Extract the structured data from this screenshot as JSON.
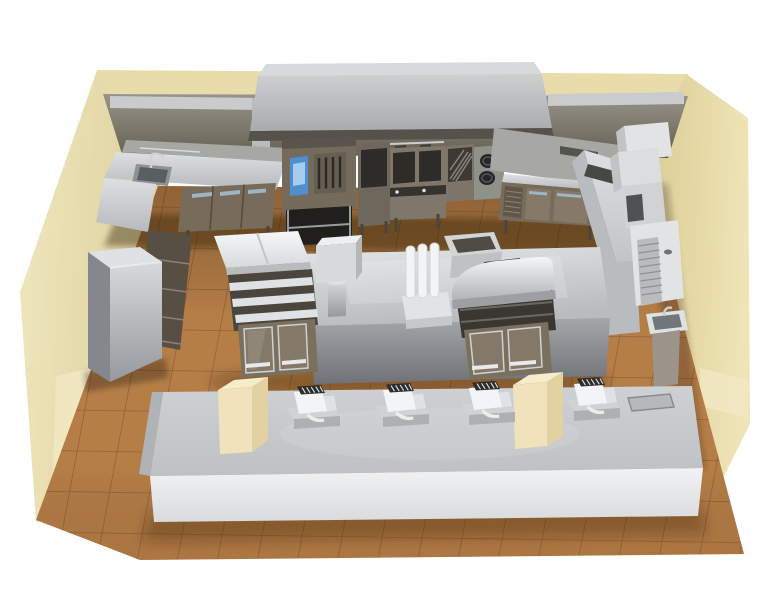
{
  "scene": {
    "type": "3d-render",
    "subject": "Commercial fast-food kitchen layout, isometric overhead view",
    "background": "#ffffff"
  },
  "colors": {
    "wallMid": "#e8dcaa",
    "wallLight": "#f1e8c2",
    "railSteel": "#c9cbcd",
    "hoodTop": "#d7d9db",
    "hoodTrim": "#55524c",
    "floorBase": "#b57e47",
    "splashGray": "#a7a7a3",
    "steelLight": "#dfe2e4",
    "steelMid": "#b9bcbe",
    "steelDark": "#8f9295",
    "brownBody": "#776b59",
    "brownDoor": "#857968",
    "brownDark": "#5f574a",
    "drawerBody": "#584f44",
    "fridgeSide": "#84888c",
    "ovenBody": "#756b5c",
    "ovenTop": "#5a544c",
    "ovenDoor": "#665e50",
    "cavityDark": "#211f1c",
    "panelDark": "#2e2c28",
    "screenBlue": "#4f8fd0",
    "screenBlueLight": "#a8ccf0",
    "holdBody": "#6e675c",
    "fryerBody": "#7f776a",
    "basketDark": "#3f3d38",
    "controlDark": "#35332e",
    "broilBody": "#7c7568",
    "louverDark": "#3d3a34",
    "burnerBody": "#8f9288",
    "burnerDark": "#26262a",
    "slotDark": "#55534d",
    "dropinDark": "#464844",
    "offWhite": "#e2e3e5",
    "cabSide": "#c2c3c5",
    "microDark": "#4e5254",
    "sinkInner": "#595e60",
    "basinDark": "#70767a",
    "pedestalTan": "#9a948a",
    "glassBrown": "#7b6f5d",
    "handleSilver": "#e8e9eb",
    "handleBlue": "#9fb4c4",
    "shelfDark": "#4a463e",
    "binCavity": "#4f4c46",
    "trayDark": "#3c3a36",
    "white": "#f3f4f5",
    "plinth": "#d0d2d4",
    "plinthFront": "#aeb0b2",
    "ventDark": "#2d2d2d",
    "creamFront": "#f0e3bb",
    "creamSide": "#e2d2a2",
    "creamTop": "#f6ecca",
    "capGray": "#b0b3b5",
    "traySlot": "#b6b9bb"
  },
  "objects": {
    "walls": "cream room walls",
    "floor": "tan ceramic tile floor",
    "exhaust_hood": "exhaust hood",
    "sink_counter": "corner sink counter with faucet",
    "under_sink_cabinets": "base cabinets with handles",
    "combi_oven": "combi oven with blue display on open stand",
    "holding_cabinet": "holding cabinet",
    "fryer_station": "double deep fryer with baskets",
    "charbroiler": "charbroiler",
    "double_burner": "twin round burner unit",
    "worktop_fridge": "refrigerated worktop with vent panel and two doors",
    "return_counter": "right-wall return counter",
    "wall_cabinets": "white wall cabinets",
    "microwave_unit": "countertop oven unit",
    "ice_machine": "ice machine with corrugated grille",
    "hand_sink": "pedestal hand-wash sink",
    "upright_fridge": "tall upright refrigerator",
    "drawer_unit": "drawer column",
    "prep_table": "tiered prep table",
    "glass_cabinets": "glass-door base cabinets",
    "island_counter": "stainless center island",
    "pedestal_unit": "pedestal-mounted unit",
    "pump_dispensers": "three pump dispensers",
    "heat_lamp_station": "curved heated holding station",
    "ingredient_bin": "open ingredient bin",
    "service_counter": "front service counter",
    "cream_pillars": "two cream counter pillars",
    "pos_terminals": "four POS register terminals",
    "tray_slot": "tray drop slot"
  }
}
